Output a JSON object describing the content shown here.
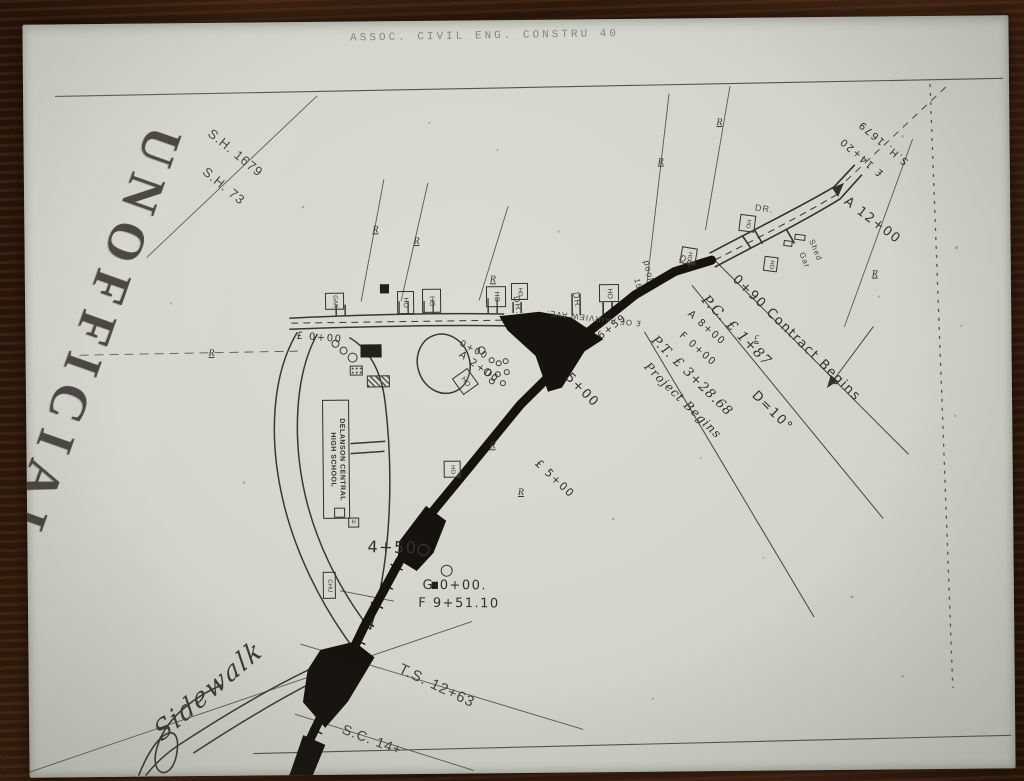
{
  "photo": {
    "wood_color": "#2b1a10",
    "paper_color": "#d6d8ce",
    "ink_color": "#2e2c28"
  },
  "header": {
    "doc_title": "ASSOC. CIVIL ENG. CONSTRU  40"
  },
  "watermark": {
    "text": "UNOFFICIAL"
  },
  "map": {
    "school": {
      "line1": "DELANSON CENTRAL",
      "line2": "HIGH SCHOOL"
    },
    "labels": [
      {
        "t": "S.H. 1679",
        "x": 238,
        "y": 150,
        "r": 40,
        "s": 13,
        "c": "print"
      },
      {
        "t": "S.H. 73",
        "x": 226,
        "y": 183,
        "r": 40,
        "s": 13,
        "c": "print"
      },
      {
        "t": "S.H. 1679",
        "x": 886,
        "y": 146,
        "r": 221,
        "s": 10,
        "c": "hand"
      },
      {
        "t": "£ 14+20",
        "x": 864,
        "y": 160,
        "r": 221,
        "s": 10,
        "c": "hand"
      },
      {
        "t": "A 12+00",
        "x": 874,
        "y": 224,
        "r": 38,
        "s": 13,
        "c": "hand"
      },
      {
        "t": "DR.",
        "x": 766,
        "y": 211,
        "r": 8,
        "s": 9,
        "c": "print"
      },
      {
        "t": "Shed",
        "x": 817,
        "y": 253,
        "r": 68,
        "s": 8,
        "c": "print"
      },
      {
        "t": "Gar",
        "x": 806,
        "y": 263,
        "r": 68,
        "s": 8,
        "c": "print"
      },
      {
        "t": "0+90 Contract Begins",
        "x": 797,
        "y": 341,
        "r": 45,
        "s": 13,
        "c": "hand"
      },
      {
        "t": "P.C. £ 1+87",
        "x": 737,
        "y": 333,
        "r": 46,
        "s": 14,
        "c": "script"
      },
      {
        "t": "A 8+00",
        "x": 707,
        "y": 330,
        "r": 42,
        "s": 10,
        "c": "hand"
      },
      {
        "t": "F 0+00",
        "x": 698,
        "y": 351,
        "r": 42,
        "s": 10,
        "c": "hand"
      },
      {
        "t": "D=10°",
        "x": 772,
        "y": 414,
        "r": 45,
        "s": 13,
        "c": "hand"
      },
      {
        "t": "P.T. £ 3+28.68",
        "x": 692,
        "y": 378,
        "r": 45,
        "s": 13,
        "c": "script"
      },
      {
        "t": "Project Begins",
        "x": 683,
        "y": 402,
        "r": 45,
        "s": 12,
        "c": "script"
      },
      {
        "t": "£ OF FAIRVIEW AVE.",
        "x": 594,
        "y": 319,
        "r": 187,
        "s": 8,
        "c": "print"
      },
      {
        "t": "6+59",
        "x": 613,
        "y": 328,
        "r": -38,
        "s": 10,
        "c": "hand"
      },
      {
        "t": "pool",
        "x": 650,
        "y": 272,
        "r": 78,
        "s": 9,
        "c": "print"
      },
      {
        "t": "15",
        "x": 639,
        "y": 285,
        "r": 78,
        "s": 8,
        "c": "print"
      },
      {
        "t": "DR",
        "x": 578,
        "y": 300,
        "r": 80,
        "s": 9,
        "c": "print"
      },
      {
        "t": "DR.",
        "x": 519,
        "y": 305,
        "r": 80,
        "s": 9,
        "c": "print"
      },
      {
        "t": "DR.",
        "x": 689,
        "y": 264,
        "r": 40,
        "s": 9,
        "c": "print"
      },
      {
        "t": "£ 0+00",
        "x": 320,
        "y": 336,
        "r": 5,
        "s": 10,
        "c": "hand"
      },
      {
        "t": "0+00",
        "x": 474,
        "y": 350,
        "r": 28,
        "s": 9,
        "c": "hand"
      },
      {
        "t": "A 2+00",
        "x": 479,
        "y": 367,
        "r": 36,
        "s": 10,
        "c": "hand"
      },
      {
        "t": "4+50",
        "x": 391,
        "y": 546,
        "r": 2,
        "s": 16,
        "c": "hand"
      },
      {
        "t": "G 0+00.",
        "x": 453,
        "y": 585,
        "r": 1,
        "s": 13,
        "c": "hand"
      },
      {
        "t": "F 9+51.10",
        "x": 457,
        "y": 603,
        "r": 1,
        "s": 13,
        "c": "hand"
      },
      {
        "t": "5+00",
        "x": 582,
        "y": 391,
        "r": 46,
        "s": 13,
        "c": "hand"
      },
      {
        "t": "£ 5+00",
        "x": 554,
        "y": 479,
        "r": 44,
        "s": 11,
        "c": "hand"
      },
      {
        "t": "T.S. 12+63",
        "x": 434,
        "y": 685,
        "r": 26,
        "s": 15,
        "c": "print"
      },
      {
        "t": "S.C. 14+",
        "x": 369,
        "y": 738,
        "r": 21,
        "s": 14,
        "c": "print"
      },
      {
        "t": "Sidewalk",
        "x": 206,
        "y": 688,
        "r": -40,
        "s": 26,
        "c": "cursive"
      }
    ],
    "buildings": [
      {
        "t": "GAR",
        "x": 326,
        "y": 291,
        "w": 19,
        "h": 17,
        "r": 0,
        "lr": 90,
        "s": 6
      },
      {
        "t": "HO",
        "x": 398,
        "y": 290,
        "w": 17,
        "h": 23,
        "r": 0,
        "lr": 90,
        "s": 7
      },
      {
        "t": "HO",
        "x": 423,
        "y": 288,
        "w": 19,
        "h": 24,
        "r": 0,
        "lr": 90,
        "s": 7
      },
      {
        "t": "HO",
        "x": 487,
        "y": 286,
        "w": 20,
        "h": 21,
        "r": 0,
        "lr": 90,
        "s": 7
      },
      {
        "t": "HO",
        "x": 512,
        "y": 283,
        "w": 17,
        "h": 17,
        "r": 0,
        "lr": 90,
        "s": 6
      },
      {
        "t": "HO",
        "x": 600,
        "y": 285,
        "w": 20,
        "h": 18,
        "r": 0,
        "lr": 90,
        "s": 7
      },
      {
        "t": "HO",
        "x": 682,
        "y": 249,
        "w": 16,
        "h": 17,
        "r": 10,
        "lr": 90,
        "s": 6
      },
      {
        "t": "HO",
        "x": 741,
        "y": 217,
        "w": 16,
        "h": 17,
        "r": 8,
        "lr": 90,
        "s": 6
      },
      {
        "t": "HO",
        "x": 765,
        "y": 259,
        "w": 14,
        "h": 15,
        "r": 8,
        "lr": 90,
        "s": 6
      },
      {
        "t": "HO",
        "x": 456,
        "y": 371,
        "w": 19,
        "h": 20,
        "r": -35,
        "lr": 90,
        "s": 7
      },
      {
        "t": "HO",
        "x": 443,
        "y": 460,
        "w": 17,
        "h": 17,
        "r": 0,
        "lr": 90,
        "s": 6
      },
      {
        "t": "CHU",
        "x": 321,
        "y": 570,
        "w": 13,
        "h": 27,
        "r": 0,
        "lr": 90,
        "s": 6
      },
      {
        "t": "H",
        "x": 347,
        "y": 516,
        "w": 11,
        "h": 10,
        "r": 0,
        "lr": 0,
        "s": 6
      },
      {
        "t": "",
        "x": 333,
        "y": 506,
        "w": 11,
        "h": 10,
        "r": 0
      },
      {
        "t": "",
        "x": 796,
        "y": 237,
        "w": 11,
        "h": 6,
        "r": 8
      },
      {
        "t": "",
        "x": 785,
        "y": 243,
        "w": 9,
        "h": 6,
        "r": 8
      },
      {
        "t": "",
        "x": 361,
        "y": 343,
        "w": 21,
        "h": 13,
        "r": 0,
        "v": "fill"
      },
      {
        "t": "",
        "x": 381,
        "y": 283,
        "w": 9,
        "h": 9,
        "r": 0,
        "v": "fill"
      },
      {
        "t": "",
        "x": 350,
        "y": 364,
        "w": 13,
        "h": 10,
        "r": 0,
        "v": "dots"
      },
      {
        "t": "",
        "x": 367,
        "y": 374,
        "w": 23,
        "h": 12,
        "r": 0,
        "v": "hatch"
      },
      {
        "t": "",
        "x": 430,
        "y": 581,
        "w": 6,
        "h": 7,
        "r": 0,
        "v": "fill"
      }
    ],
    "trees": [
      {
        "x": 336,
        "y": 342,
        "r": 4
      },
      {
        "x": 344,
        "y": 349,
        "r": 4
      },
      {
        "x": 353,
        "y": 356,
        "r": 5
      },
      {
        "x": 482,
        "y": 350,
        "r": 4
      },
      {
        "x": 492,
        "y": 360,
        "r": 3
      },
      {
        "x": 499,
        "y": 363,
        "r": 3
      },
      {
        "x": 506,
        "y": 361,
        "r": 3
      },
      {
        "x": 488,
        "y": 372,
        "r": 4
      },
      {
        "x": 498,
        "y": 374,
        "r": 3
      },
      {
        "x": 507,
        "y": 372,
        "r": 3
      },
      {
        "x": 492,
        "y": 381,
        "r": 3
      },
      {
        "x": 503,
        "y": 383,
        "r": 3
      },
      {
        "x": 422,
        "y": 549,
        "r": 6
      },
      {
        "x": 445,
        "y": 570,
        "r": 6
      }
    ],
    "r_symbols": [
      {
        "x": 212,
        "y": 350,
        "t": "R"
      },
      {
        "x": 377,
        "y": 228,
        "t": "R"
      },
      {
        "x": 418,
        "y": 240,
        "t": "R"
      },
      {
        "x": 494,
        "y": 279,
        "t": "R"
      },
      {
        "x": 663,
        "y": 163,
        "t": "R"
      },
      {
        "x": 722,
        "y": 124,
        "t": "R"
      },
      {
        "x": 876,
        "y": 277,
        "t": "R"
      },
      {
        "x": 492,
        "y": 445,
        "t": "R"
      },
      {
        "x": 520,
        "y": 492,
        "t": "R"
      },
      {
        "x": 757,
        "y": 341,
        "t": "£"
      }
    ]
  }
}
